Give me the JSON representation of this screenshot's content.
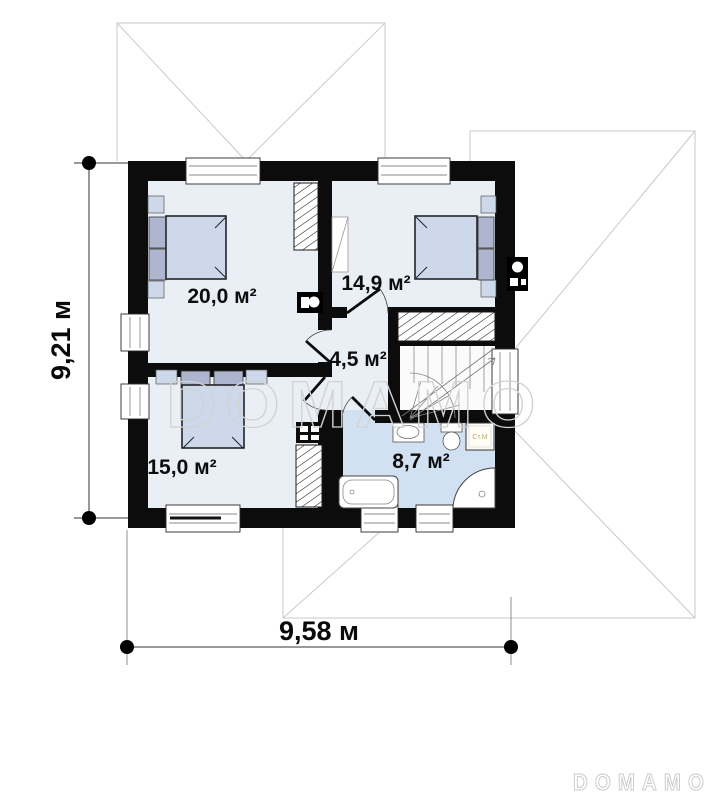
{
  "plan": {
    "watermark": "DOMAMO",
    "logo": "DOMAMO",
    "dimensions": {
      "height": "9,21 м",
      "width": "9,58 м"
    },
    "rooms": [
      {
        "name": "bedroom-top-left",
        "area": "20,0 м²"
      },
      {
        "name": "bedroom-top-right",
        "area": "14,9 м²"
      },
      {
        "name": "hall",
        "area": "4,5 м²"
      },
      {
        "name": "bedroom-bottom-left",
        "area": "15,0 м²"
      },
      {
        "name": "bathroom",
        "area": "8,7 м²"
      }
    ],
    "appliances": {
      "washing_machine": "Ст.М"
    },
    "colors": {
      "wall": "#0c0c0c",
      "room_floor": "#eaeff6",
      "bathroom_floor": "#d2e1f1",
      "stair_floor": "#fbfbfb",
      "furniture": "#cdd9ea",
      "pillow": "#adb6ce",
      "roof_line": "#c9c9c9",
      "watermark": "#d2d2d2"
    }
  }
}
